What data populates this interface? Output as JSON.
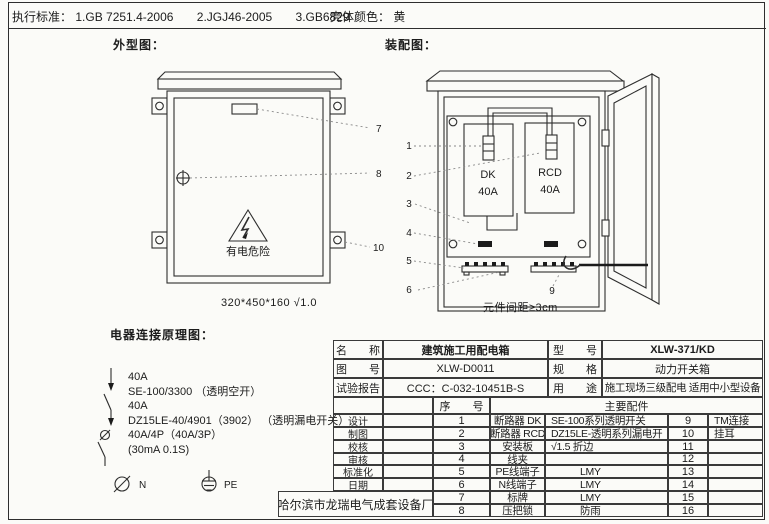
{
  "colors": {
    "paper": "#fbfbf8",
    "ink": "#2e2e2e"
  },
  "header_bar": {
    "exec_label": "执行标准：",
    "standards": [
      "1.GB 7251.4-2006",
      "2.JGJ46-2005",
      "3.GB6829"
    ],
    "shell_color_label": "壳体颜色：",
    "shell_color_value": "黄"
  },
  "sections": {
    "outline_title": "外型图：",
    "assembly_title": "装配图：",
    "schematic_title": "电器连接原理图："
  },
  "outline": {
    "warning_text": "有电危险",
    "size_caption": "320*450*160 √1.0",
    "callout_7": "7",
    "callout_8": "8",
    "callout_10": "10"
  },
  "assembly": {
    "breaker_left_name": "DK",
    "breaker_left_rating": "40A",
    "breaker_right_name": "RCD",
    "breaker_right_rating": "40A",
    "spacing_caption": "元件间距≥3cm",
    "callout_1": "1",
    "callout_2": "2",
    "callout_3": "3",
    "callout_4": "4",
    "callout_5": "5",
    "callout_6": "6",
    "callout_9": "9"
  },
  "schematic": {
    "lines": [
      "40A",
      "SE-100/3300 （透明空开）",
      "40A",
      "DZ15LE-40/4901（3902） （透明漏电开关）",
      "40A/4P（40A/3P）",
      "(30mA 0.1S)"
    ],
    "neutral_label": "N",
    "earth_label": "PE"
  },
  "title_block": {
    "info_rows": [
      {
        "l1": "名　　称",
        "v1": "建筑施工用配电箱",
        "l2": "型　　号",
        "v2": "XLW-371/KD"
      },
      {
        "l1": "图　　号",
        "v1": "XLW-D0011",
        "l2": "规　　格",
        "v2": "动力开关箱"
      },
      {
        "l1": "试验报告",
        "v1": "CCC：C-032-10451B-S",
        "l2": "用　　途",
        "v2": "施工现场三级配电 适用中小型设备"
      }
    ],
    "serial_header": "序　　号",
    "parts_header": "主要配件",
    "sign_labels": [
      "设计",
      "制图",
      "校核",
      "审核",
      "标准化",
      "日期"
    ],
    "parts": [
      {
        "no": "1",
        "name": "断路器 DK",
        "spec": "SE-100系列透明开关",
        "no2": "9",
        "spec2": "TM连接"
      },
      {
        "no": "2",
        "name": "断路器 RCD",
        "spec": "DZ15LE-透明系列漏电开",
        "no2": "10",
        "spec2": "挂耳"
      },
      {
        "no": "3",
        "name": "安装板",
        "spec": "√1.5 折边",
        "no2": "11",
        "spec2": ""
      },
      {
        "no": "4",
        "name": "线夹",
        "spec": "",
        "no2": "12",
        "spec2": ""
      },
      {
        "no": "5",
        "name": "PE线端子",
        "spec": "LMY",
        "no2": "13",
        "spec2": ""
      },
      {
        "no": "6",
        "name": "N线端子",
        "spec": "LMY",
        "no2": "14",
        "spec2": ""
      },
      {
        "no": "7",
        "name": "标牌",
        "spec": "LMY",
        "no2": "15",
        "spec2": ""
      },
      {
        "no": "8",
        "name": "压把锁",
        "spec": "防雨",
        "no2": "16",
        "spec2": ""
      }
    ],
    "factory": "哈尔滨市龙瑞电气成套设备厂"
  }
}
